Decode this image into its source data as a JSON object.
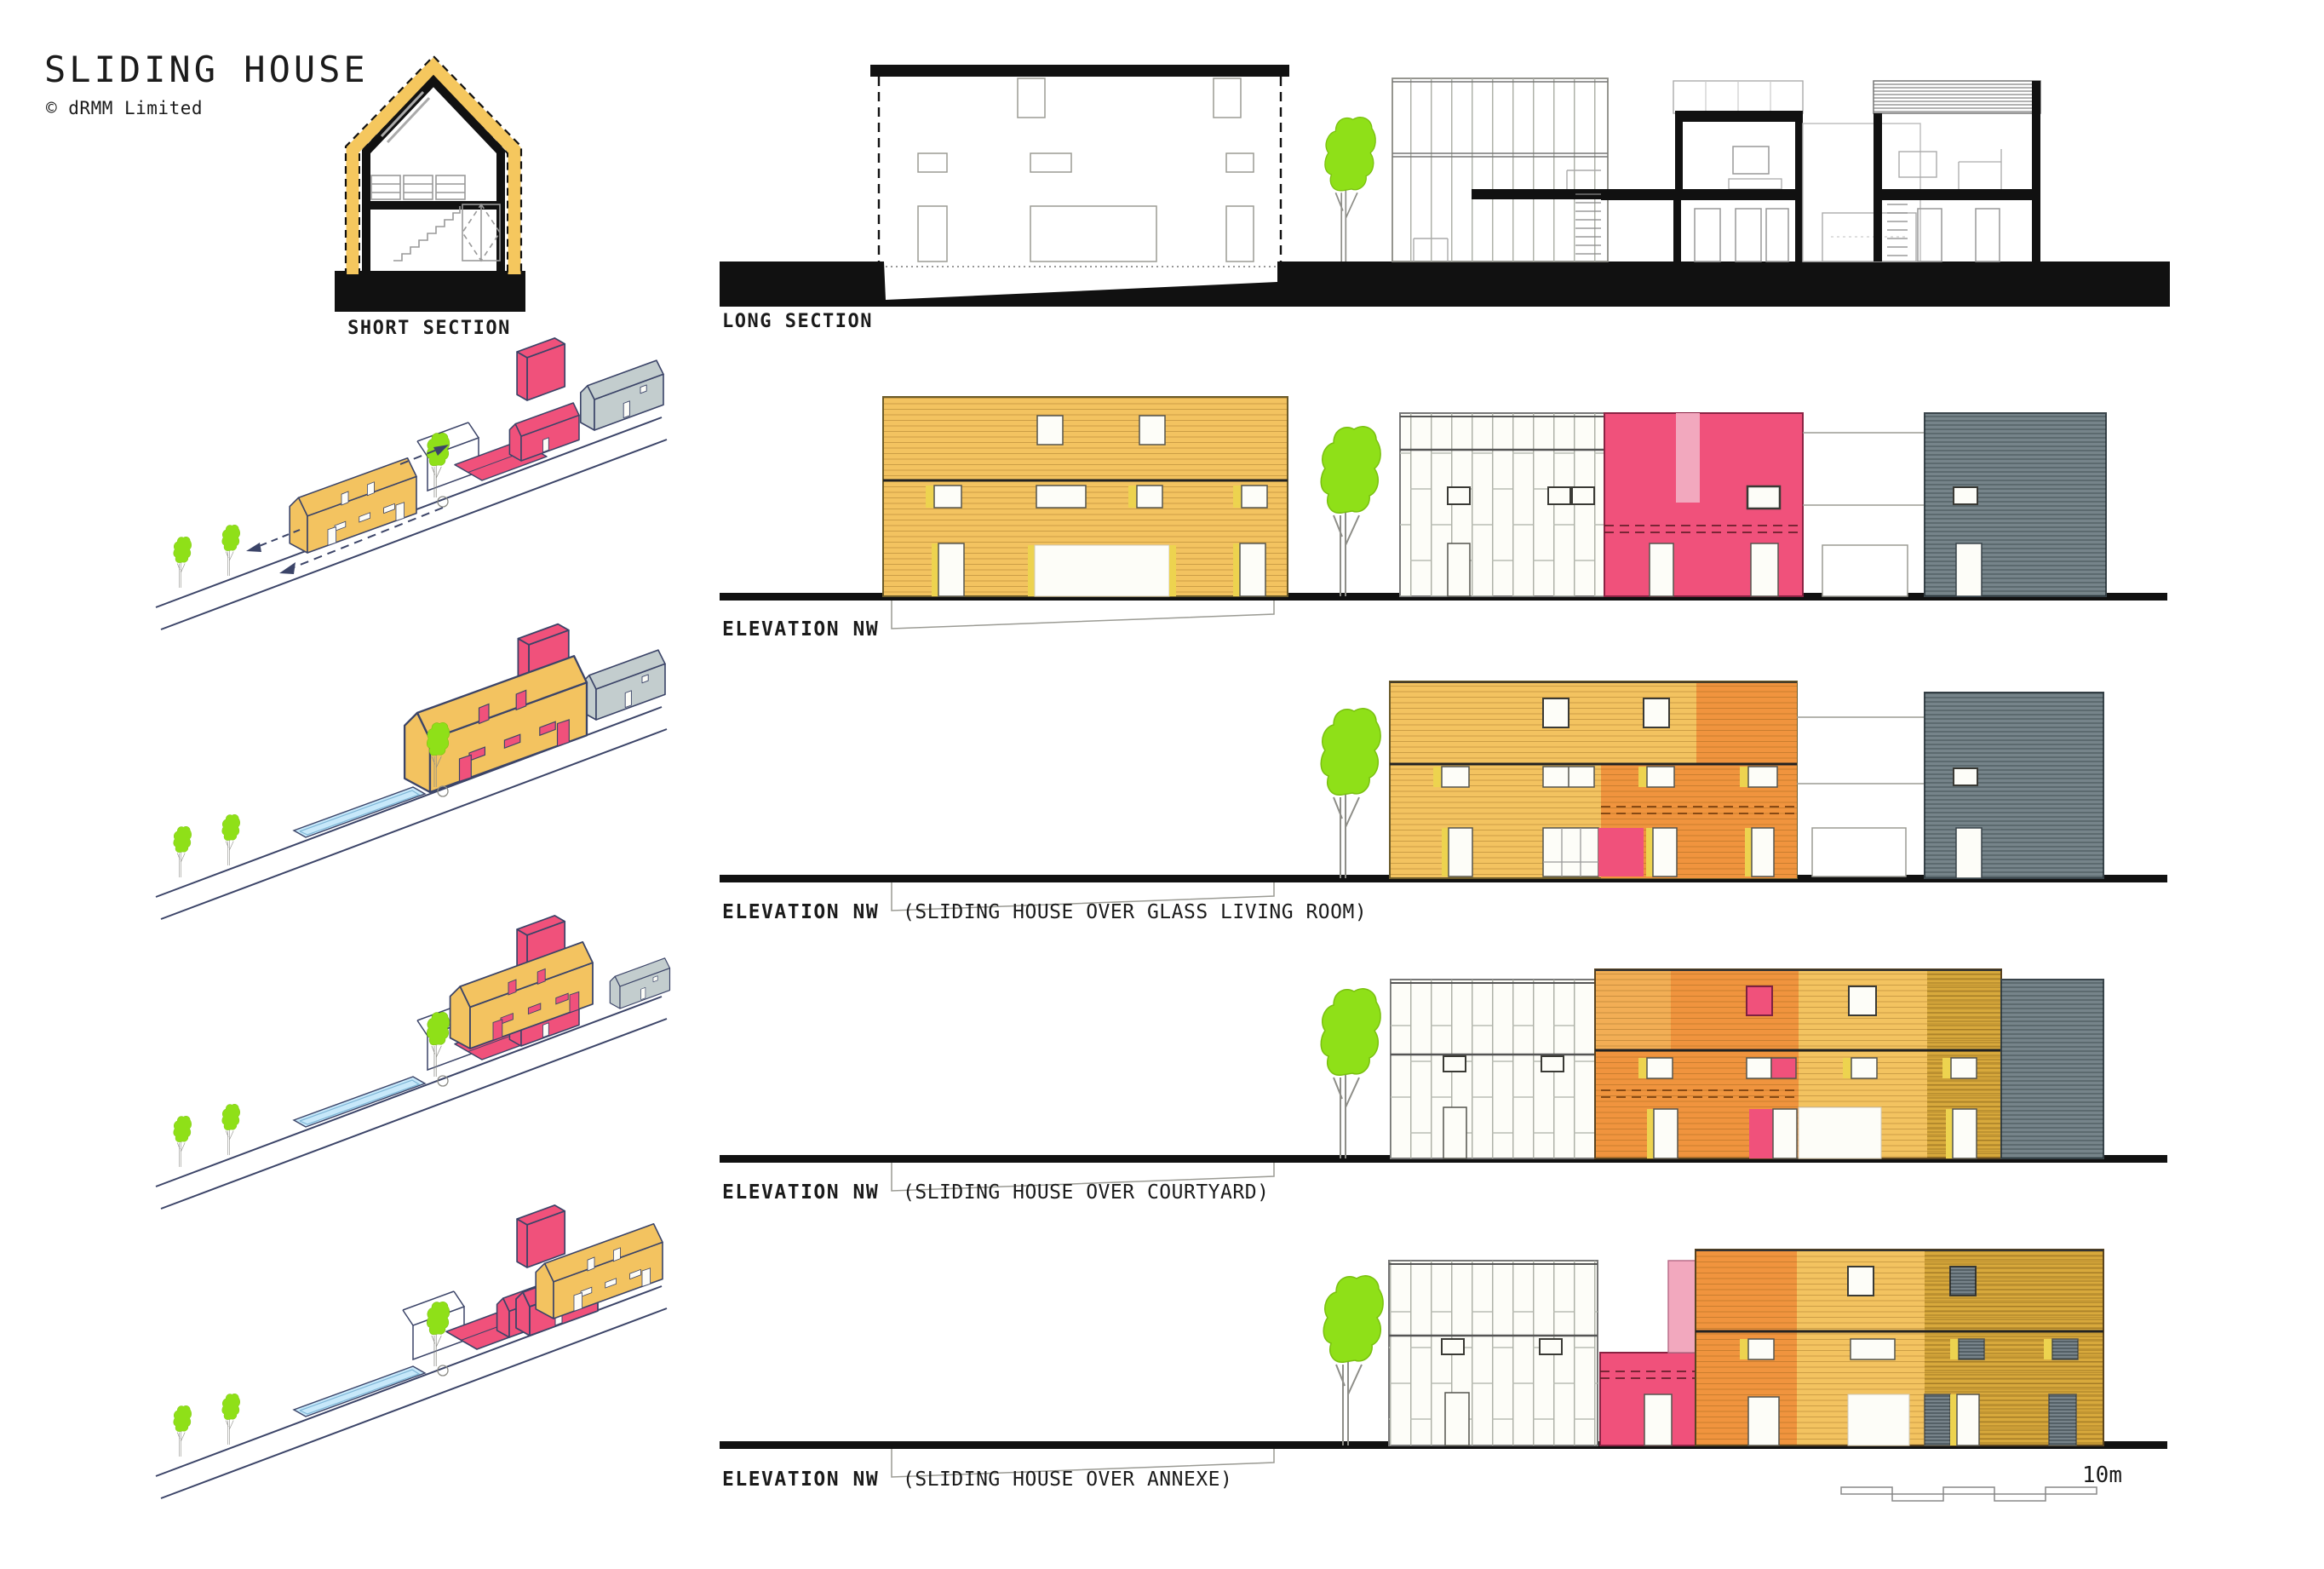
{
  "title": {
    "text": "SLIDING HOUSE",
    "copyright": "© dRMM Limited"
  },
  "sections": {
    "short": "SHORT SECTION",
    "long": "LONG SECTION"
  },
  "elevations": [
    {
      "label": "ELEVATION NW",
      "sublabel": ""
    },
    {
      "label": "ELEVATION NW",
      "sublabel": "(SLIDING HOUSE OVER GLASS LIVING ROOM)"
    },
    {
      "label": "ELEVATION NW",
      "sublabel": "(SLIDING HOUSE OVER COURTYARD)"
    },
    {
      "label": "ELEVATION NW",
      "sublabel": "(SLIDING HOUSE OVER ANNEXE)"
    }
  ],
  "scale_bar": {
    "label": "10m"
  },
  "colors": {
    "timber_yellow": "#F3C360",
    "timber_orange": "#F0943E",
    "timber_gold": "#D8A93C",
    "house_pink": "#F0517B",
    "pink_light": "#F2A8BE",
    "cladding_grey": "#76848A",
    "axon_grey": "#C3CDCE",
    "tree_green": "#8FE018",
    "pool_blue": "#C7E8FA",
    "outline_navy": "#3B4468",
    "ink_black": "#111111"
  }
}
